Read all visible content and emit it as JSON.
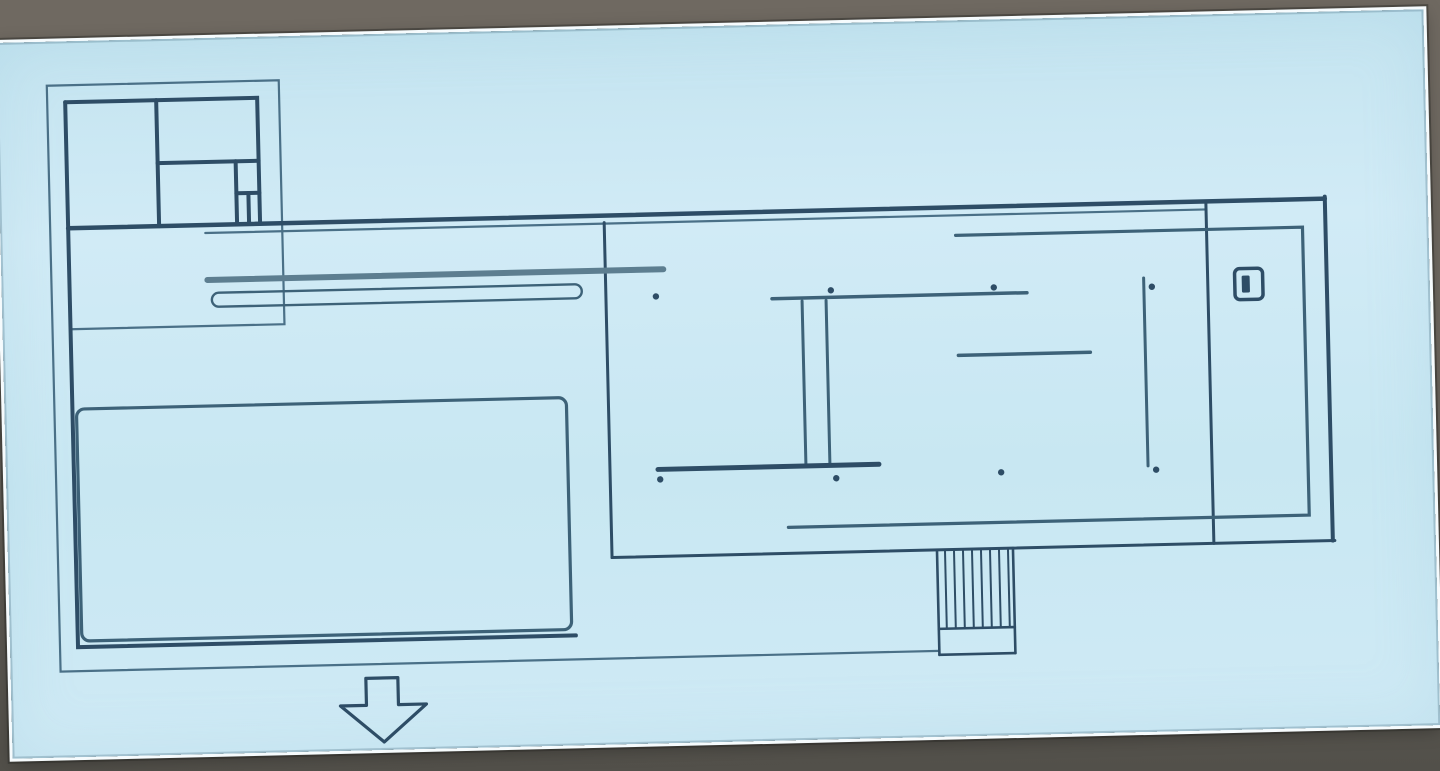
{
  "scene": {
    "kind": "photographed projection slide of an architectural floor plan",
    "colors": {
      "backdrop_top": "#6f6961",
      "backdrop_bottom": "#52504a",
      "slide_background": "#c9e8f3",
      "slide_border": "#f6fbfd",
      "line_dark": "#2e4d66",
      "line_medium": "#3d6278",
      "line_thin": "#4a7087",
      "line_light": "#5d7e90"
    }
  },
  "plan": {
    "type": "floor-plan",
    "features": [
      "podium-outline",
      "service-annex",
      "annex-room-dividers",
      "long-roof-edge",
      "west-wall",
      "large-pool",
      "interior-bench",
      "main-vertical-wall",
      "center-wall-upper",
      "onyx-double-wall",
      "center-wall-lower",
      "mid-right-wall",
      "right-vertical-wall",
      "right-terrace-outline",
      "small-pool-sculpture",
      "entrance-stairs",
      "columns",
      "entrance-arrow"
    ],
    "columns": {
      "radius": 3.2,
      "points": [
        {
          "x": 654,
          "y": 269
        },
        {
          "x": 829,
          "y": 267
        },
        {
          "x": 992,
          "y": 268
        },
        {
          "x": 1150,
          "y": 271
        },
        {
          "x": 654,
          "y": 452
        },
        {
          "x": 830,
          "y": 455
        },
        {
          "x": 995,
          "y": 453
        },
        {
          "x": 1150,
          "y": 454
        }
      ]
    },
    "stairs": {
      "tread_count": 8,
      "x_start": 937,
      "x_end": 1000,
      "y_top": 529,
      "y_bottom": 608
    },
    "entrance_arrow": {
      "direction": "down"
    }
  }
}
